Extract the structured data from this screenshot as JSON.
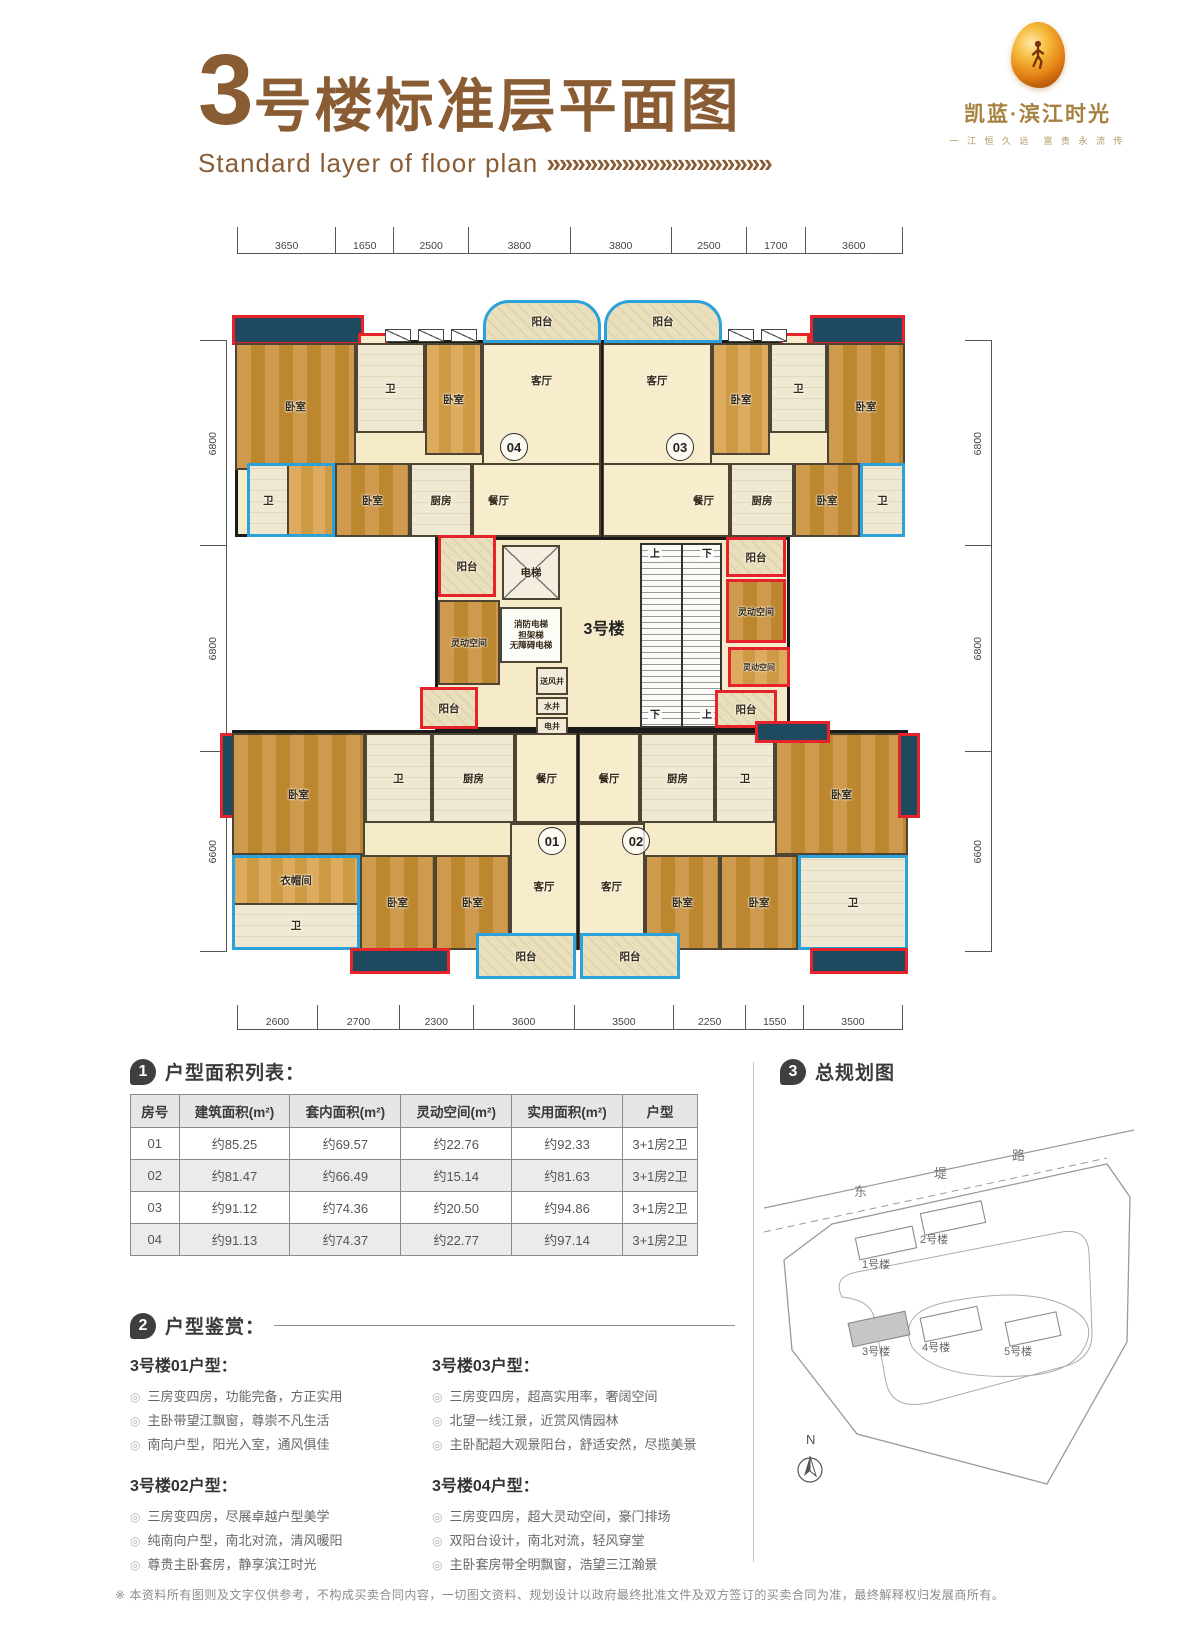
{
  "header": {
    "title_big": "3",
    "title_rest": "号楼标准层平面图",
    "subtitle": "Standard layer of floor plan",
    "subtitle_arrows": "»»»»»»»»»»»»»»»»»»",
    "logo": {
      "brand": "凯蓝·滨江时光",
      "tagline": "一 江 恒 久 远　富 贵 永 流 传"
    }
  },
  "floorplan": {
    "building_label": "3号楼",
    "dims_top": [
      "3650",
      "1650",
      "2500",
      "3800",
      "3800",
      "2500",
      "1700",
      "3600"
    ],
    "dims_bottom": [
      "2600",
      "2700",
      "2300",
      "3600",
      "3500",
      "2250",
      "1550",
      "3500"
    ],
    "dims_left": [
      "6800",
      "6800",
      "6600"
    ],
    "dims_right": [
      "6800",
      "6800",
      "6600"
    ],
    "units": {
      "u01": "01",
      "u02": "02",
      "u03": "03",
      "u04": "04"
    },
    "rooms": {
      "balcony": "阳台",
      "bedroom": "卧室",
      "bath": "卫",
      "living": "客厅",
      "dining": "餐厅",
      "kitchen": "厨房",
      "flex": "灵动空间",
      "cloak": "衣帽间",
      "elevator": "电梯",
      "fire_elevator": "消防电梯",
      "stretcher_elevator": "担架梯",
      "accessible_elevator": "无障碍电梯",
      "air_shaft": "送风井",
      "water_shaft": "水井",
      "elec_shaft": "电井",
      "up": "上",
      "down": "下"
    }
  },
  "area_table": {
    "badge": "1",
    "title": "户型面积列表：",
    "headers": [
      "房号",
      "建筑面积(m²)",
      "套内面积(m²)",
      "灵动空间(m²)",
      "实用面积(m²)",
      "户型"
    ],
    "rows": [
      [
        "01",
        "约85.25",
        "约69.57",
        "约22.76",
        "约92.33",
        "3+1房2卫"
      ],
      [
        "02",
        "约81.47",
        "约66.49",
        "约15.14",
        "约81.63",
        "3+1房2卫"
      ],
      [
        "03",
        "约91.12",
        "约74.36",
        "约20.50",
        "约94.86",
        "3+1房2卫"
      ],
      [
        "04",
        "约91.13",
        "约74.37",
        "约22.77",
        "约97.14",
        "3+1房2卫"
      ]
    ]
  },
  "appreciation": {
    "badge": "2",
    "title": "户型鉴赏：",
    "bullet": "◎",
    "blocks": [
      {
        "name": "3号楼01户型：",
        "points": [
          "三房变四房，功能完备，方正实用",
          "主卧带望江飘窗，尊崇不凡生活",
          "南向户型，阳光入室，通风俱佳"
        ]
      },
      {
        "name": "3号楼02户型：",
        "points": [
          "三房变四房，尽展卓越户型美学",
          "纯南向户型，南北对流，清风暖阳",
          "尊贵主卧套房，静享滨江时光"
        ]
      },
      {
        "name": "3号楼03户型：",
        "points": [
          "三房变四房，超高实用率，奢阔空间",
          "北望一线江景，近赏风情园林",
          "主卧配超大观景阳台，舒适安然，尽揽美景"
        ]
      },
      {
        "name": "3号楼04户型：",
        "points": [
          "三房变四房，超大灵动空间，豪门排场",
          "双阳台设计，南北对流，轻风穿堂",
          "主卧套房带全明飘窗，浩望三江瀚景"
        ]
      }
    ]
  },
  "masterplan": {
    "badge": "3",
    "title": "总规划图",
    "road_chars": [
      "东",
      "堤",
      "路"
    ],
    "buildings": [
      "1号楼",
      "2号楼",
      "3号楼",
      "4号楼",
      "5号楼"
    ],
    "compass": "N"
  },
  "footer": {
    "disclaimer": "※ 本资料所有图则及文字仅供参考，不构成买卖合同内容，一切图文资料、规划设计以政府最终批准文件及双方签订的买卖合同为准，最终解释权归发展商所有。"
  }
}
